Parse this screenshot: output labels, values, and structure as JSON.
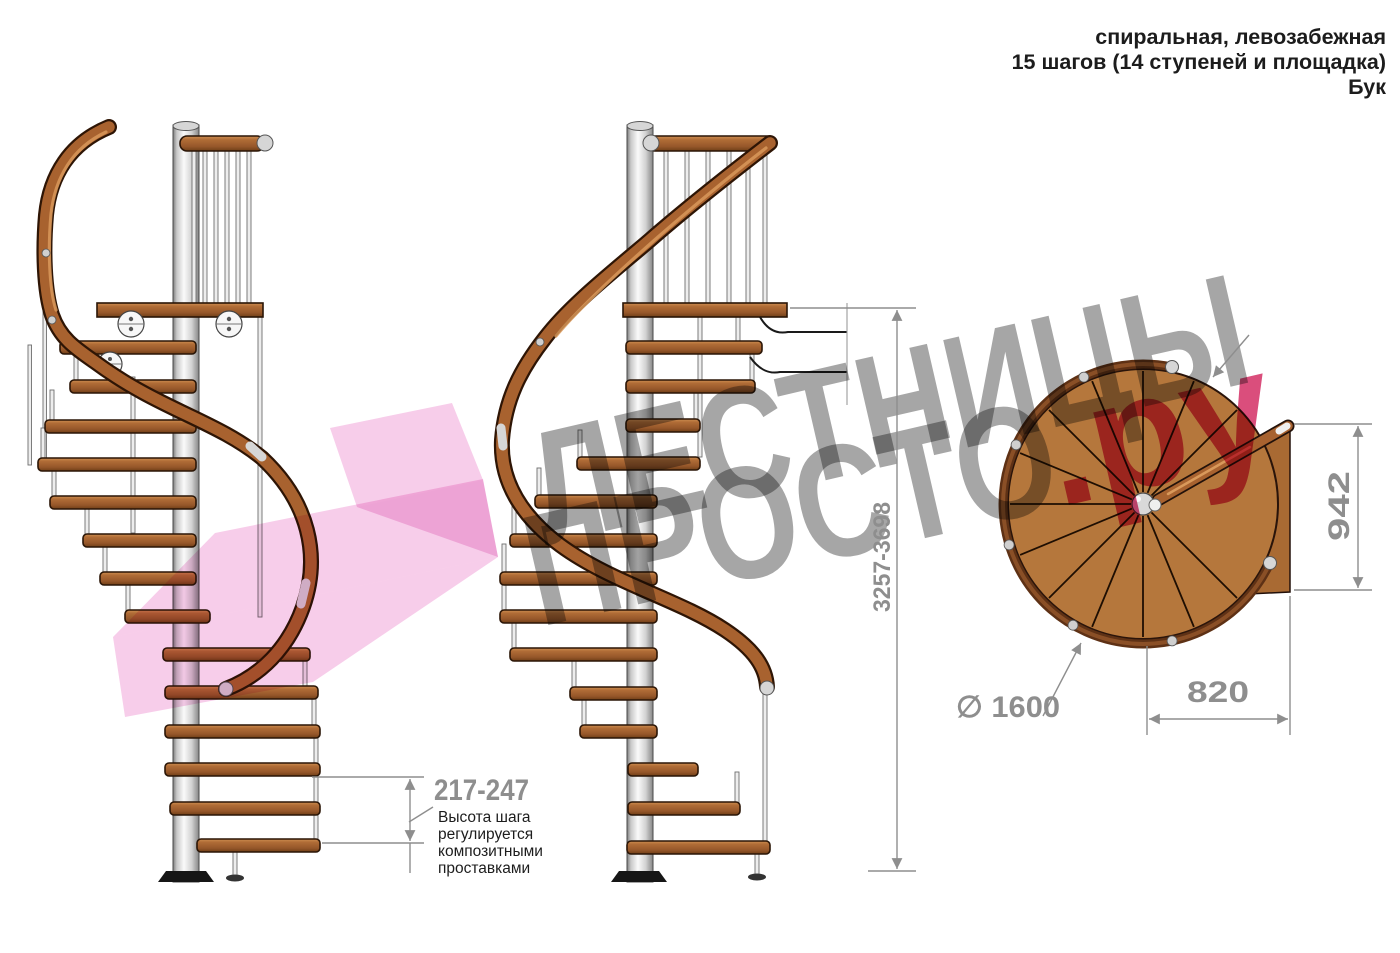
{
  "header": {
    "line1": "спиральная, левозабежная",
    "line2": "15 шагов (14 ступеней и площадка)",
    "line3": "Бук"
  },
  "watermark": {
    "word1": "ЛЕСТНИЦЫ",
    "word2": "ПРОСТО",
    "suffix": ".ру"
  },
  "dimensions": {
    "step_height": "217-247",
    "total_height": "3257-3698",
    "landing_depth": "942",
    "landing_width": "820",
    "diameter": "∅ 1600",
    "note_line1": "Высота шага",
    "note_line2": "регулируется",
    "note_line3": "композитными",
    "note_line4": "проставками"
  },
  "colors": {
    "wood": "#a8622f",
    "pole": "#d9d9d9",
    "dimension_gray": "#8e8e8e",
    "watermark_gray": "#9a9a9a",
    "watermark_pink": "#f3aedd",
    "watermark_crimson": "#d63a6e"
  }
}
